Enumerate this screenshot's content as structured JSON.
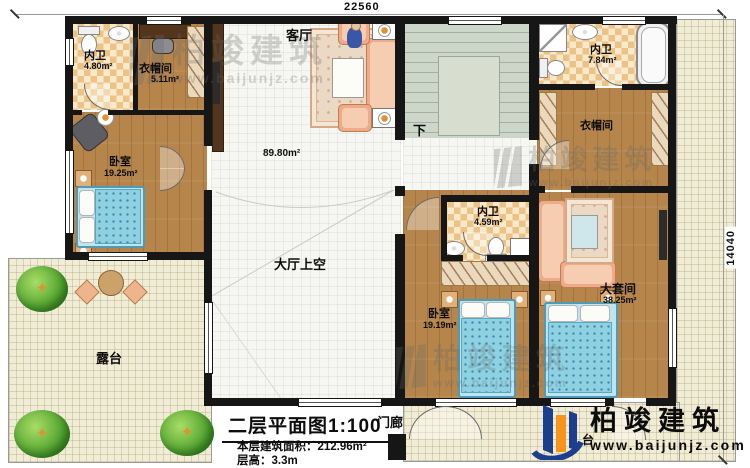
{
  "dimensions": {
    "width_label": "22560",
    "height_label": "14040"
  },
  "rooms": {
    "bath1": {
      "name": "内卫",
      "area": "4.80m²"
    },
    "cloak1": {
      "name": "衣帽间",
      "area": "5.11m²"
    },
    "living": {
      "name": "客厅",
      "area": "89.80m²"
    },
    "bath2": {
      "name": "内卫",
      "area": "7.84m²"
    },
    "cloak2": {
      "name": "衣帽间"
    },
    "bed1": {
      "name": "卧室",
      "area": "19.25m²"
    },
    "hallvoid": {
      "name": "大厅上空"
    },
    "bath3": {
      "name": "内卫",
      "area": "4.59m²"
    },
    "suite": {
      "name": "大套间",
      "area": "38.25m²"
    },
    "bed2": {
      "name": "卧室",
      "area": "19.19m²"
    },
    "terrace": {
      "name": "露台"
    },
    "porch": {
      "name": "门廊"
    },
    "balcony": {
      "name": "台"
    }
  },
  "stairs": {
    "down": "下"
  },
  "titleblock": {
    "title": "二层平面图1:100",
    "area": "本层建筑面积：212.96m²",
    "floor_height": "层高：3.3m"
  },
  "brand": {
    "name": "柏竣建筑",
    "url": "www.baijunjz.com"
  },
  "watermark": {
    "name": "柏竣建筑",
    "url": "www.baijunjz.com"
  },
  "colors": {
    "wall": "#161616",
    "bed_blue": "#8ed1e3",
    "sofa": "#eeab89",
    "logo_blue": "#1b3e8e",
    "logo_orange": "#f7941d"
  }
}
